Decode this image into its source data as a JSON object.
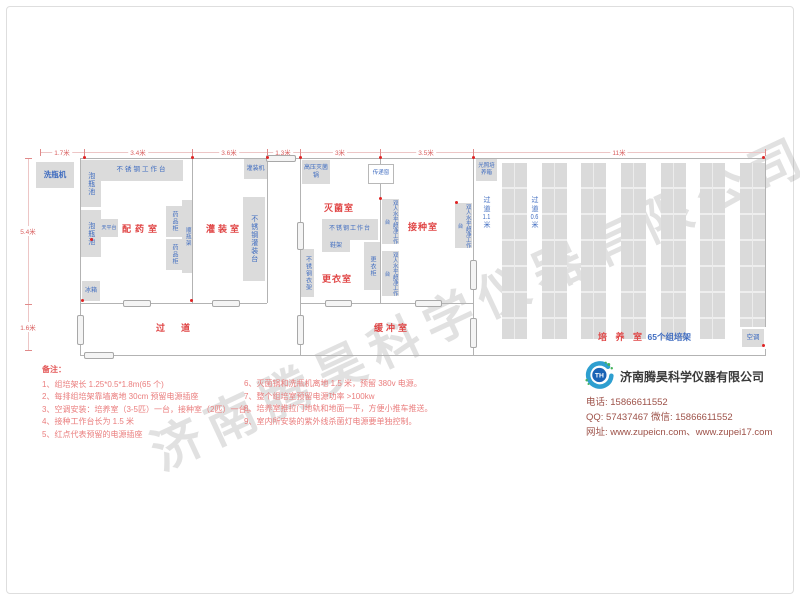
{
  "watermark": "济南腾昊科学仪器有限公司",
  "dims": {
    "top": [
      "1.7米",
      "3.4米",
      "3.6米",
      "1.3米",
      "3米",
      "3.5米",
      "11米"
    ],
    "left": [
      "5.4米",
      "1.6米"
    ]
  },
  "rooms": {
    "dispensing": "配药室",
    "filling": "灌装室",
    "sterilizing": "灭菌室",
    "changing": "更衣室",
    "inoculation": "接种室",
    "corridor": "过道",
    "buffer": "缓冲室",
    "culture": "培 养 室",
    "culture_racks": "65个组培架"
  },
  "aisles": {
    "a1": {
      "prefix": "过道",
      "num": "1.1",
      "suffix": "米"
    },
    "a2": {
      "prefix": "过道",
      "num": "0.6",
      "suffix": "米"
    }
  },
  "equip": {
    "washer": "洗瓶机",
    "soak": "泡瓶池",
    "workbench": "不锈钢工作台",
    "balance": "天平台",
    "fridge": "冰箱",
    "cabinet": "药品柜",
    "bottle_rack": "顺瓶架",
    "filler": "灌装机",
    "filling_table": "不锈钢灌装台",
    "autoclave": "高压灭菌锅",
    "pass_window": "传递窗",
    "workbench2": "不锈钢工作台",
    "shoe_rack": "鞋架",
    "wardrobe": "更衣柜",
    "clothes_rack": "不锈钢衣架",
    "laminar": "双人水平超净工作台",
    "incubator": "光照培养箱",
    "ac": "空调"
  },
  "notes": {
    "title": "备注：",
    "left": [
      "1、组培架长 1.25*0.5*1.8m(65 个)",
      "2、每排组培架靠墙离地 30cm 预留电源插座",
      "3、空调安装：培养室（3-5匹）一台，接种室（2匹）一台。",
      "4、接种工作台长为 1.5 米",
      "5、红点代表预留的电源插座"
    ],
    "right": [
      "6、灭菌锅和洗瓶机离地 1.5 米，预留 380v 电源。",
      "7、整个组培室预留电源功率 >100kw",
      "8、培养室推拉门地轨和地面一平，方便小推车推送。",
      "9、室内所安装的紫外线杀菌灯电源要单独控制。"
    ]
  },
  "company": {
    "name": "济南腾昊科学仪器有限公司",
    "logo": "TH",
    "lines": [
      "电话: 15866611552",
      "QQ: 57437467   微信: 15866611552",
      "网址: www.zupeicn.com、www.zupei17.com"
    ]
  },
  "colors": {
    "room_label": "#e04545",
    "equip_text": "#3f6cc0",
    "dim_text": "#d96060",
    "note_text": "#ea7d7d",
    "box_fill": "#dbdbdb",
    "logo_blue": "#1a63b5",
    "logo_green": "#45b35a",
    "contact_text": "#9d5148"
  }
}
